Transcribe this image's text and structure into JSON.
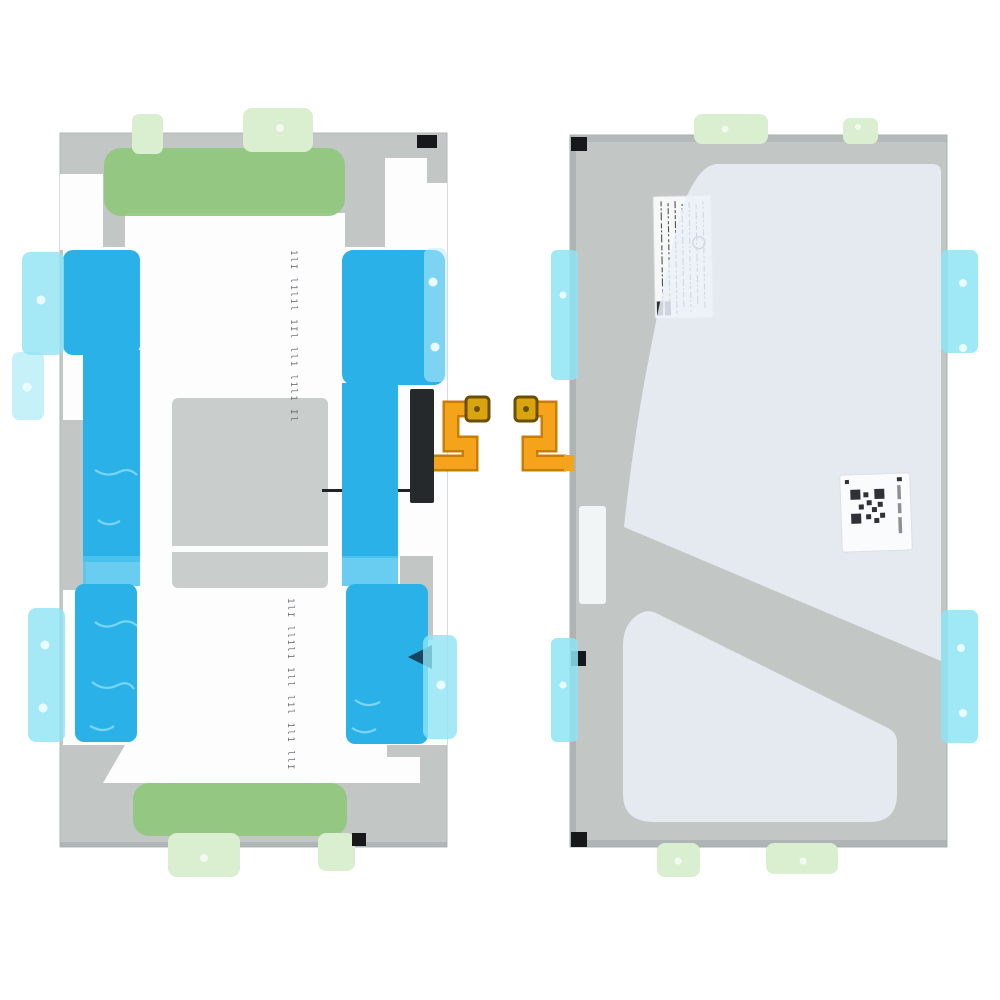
{
  "title": "Tablet battery with pre-applied adhesive sheets, front and rear product views",
  "background": "#ffffff",
  "colors": {
    "battery_gray": "#c2c7c6",
    "battery_gray_dark": "#aeb4b4",
    "battery_edge": "#a2a8a8",
    "sheet_white": "#fdfdfe",
    "inner_gray": "#c9cdcc",
    "adhesive_blue": "#2ab2e8",
    "adhesive_blue_light": "#4fc4ee",
    "squiggle_blue": "#8fdef5",
    "tab_cyan": "#8ee4f4",
    "tab_cyan_pale": "#bfeffa",
    "notch_navy": "#16455e",
    "adhesive_green": "#90c87c",
    "tab_green": "#d9efcf",
    "tab_dot": "#f2f9ee",
    "rivet_dot": "#eafcff",
    "flex_orange": "#f5a31a",
    "flex_orange_dark": "#c87d05",
    "pad_gold": "#d9a50e",
    "pad_border": "#6b4e04",
    "connector_black": "#26292c",
    "film_white": "#ebf0f8",
    "label_white": "#f6f8f8",
    "label_ink": "#4a5054",
    "qr_ink": "#2e3236",
    "mark_black": "#17181a",
    "wire_black": "#202325"
  },
  "left_unit": {
    "name": "battery-front-with-adhesive-sheet",
    "microprint_upper": "1lI l1l1l 1Il ll1 l1l1 Il",
    "microprint_lower": "1lI ll1l1 1ll l1l 1l1 llI"
  },
  "right_unit": {
    "name": "battery-rear-with-protective-film"
  }
}
